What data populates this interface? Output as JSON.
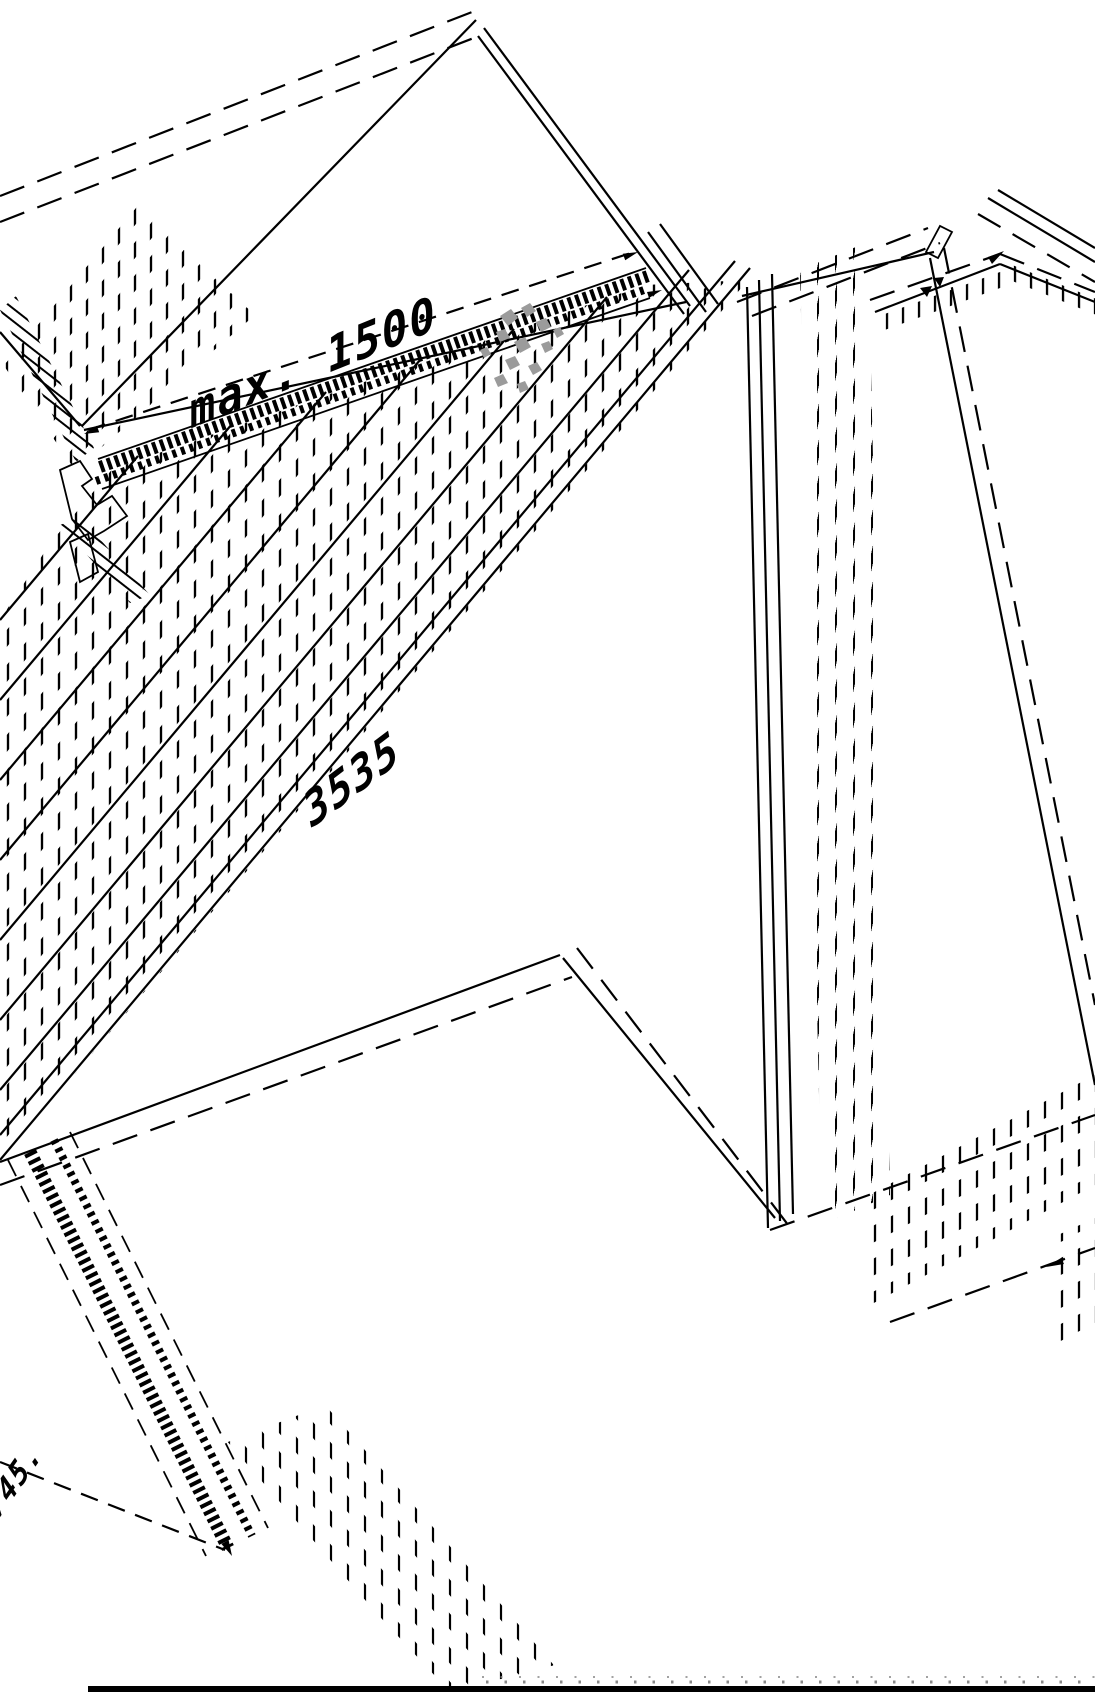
{
  "page": {
    "background": "#ffffff",
    "line_color": "#000000",
    "muted_dot_color": "#8a8a8a",
    "watermark_color": "#9b9b9b",
    "footer_bar_color": "#000000"
  },
  "drawing": {
    "kind": "isometric-installation-diagram",
    "dimensions": {
      "top": {
        "label": "max. 1500"
      },
      "middle": {
        "label": "3535"
      },
      "bottom": {
        "label": "745."
      }
    }
  }
}
